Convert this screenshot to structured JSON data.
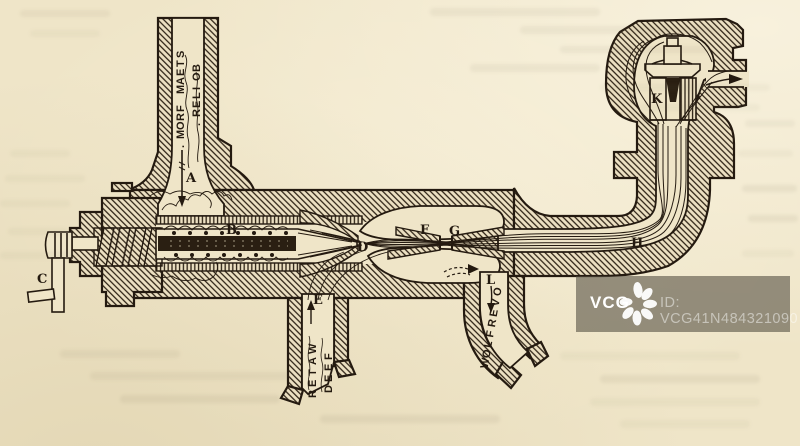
{
  "figure": {
    "subject": "Sectional engraving of a steam injector",
    "callouts": {
      "A": "A",
      "B": "B",
      "C": "C",
      "D": "D",
      "E": "E",
      "F": "F",
      "G": "G",
      "H": "H",
      "K": "K",
      "L": "L"
    },
    "steam_label_line1": "STEAM FROM.",
    "steam_label_line2": "BOILER.",
    "feed_label_line1": "FEED",
    "feed_label_line2": "WATER",
    "overflow_label": "OVERFLOW"
  },
  "watermark": {
    "brand": "VCG",
    "image_id": "ID: VCG41N484321090"
  },
  "colors": {
    "paper": "#efe5c8",
    "ink": "#241a10",
    "watermark_bar": "rgba(80,74,62,0.58)",
    "watermark_text": "rgba(255,255,255,0.48)"
  }
}
